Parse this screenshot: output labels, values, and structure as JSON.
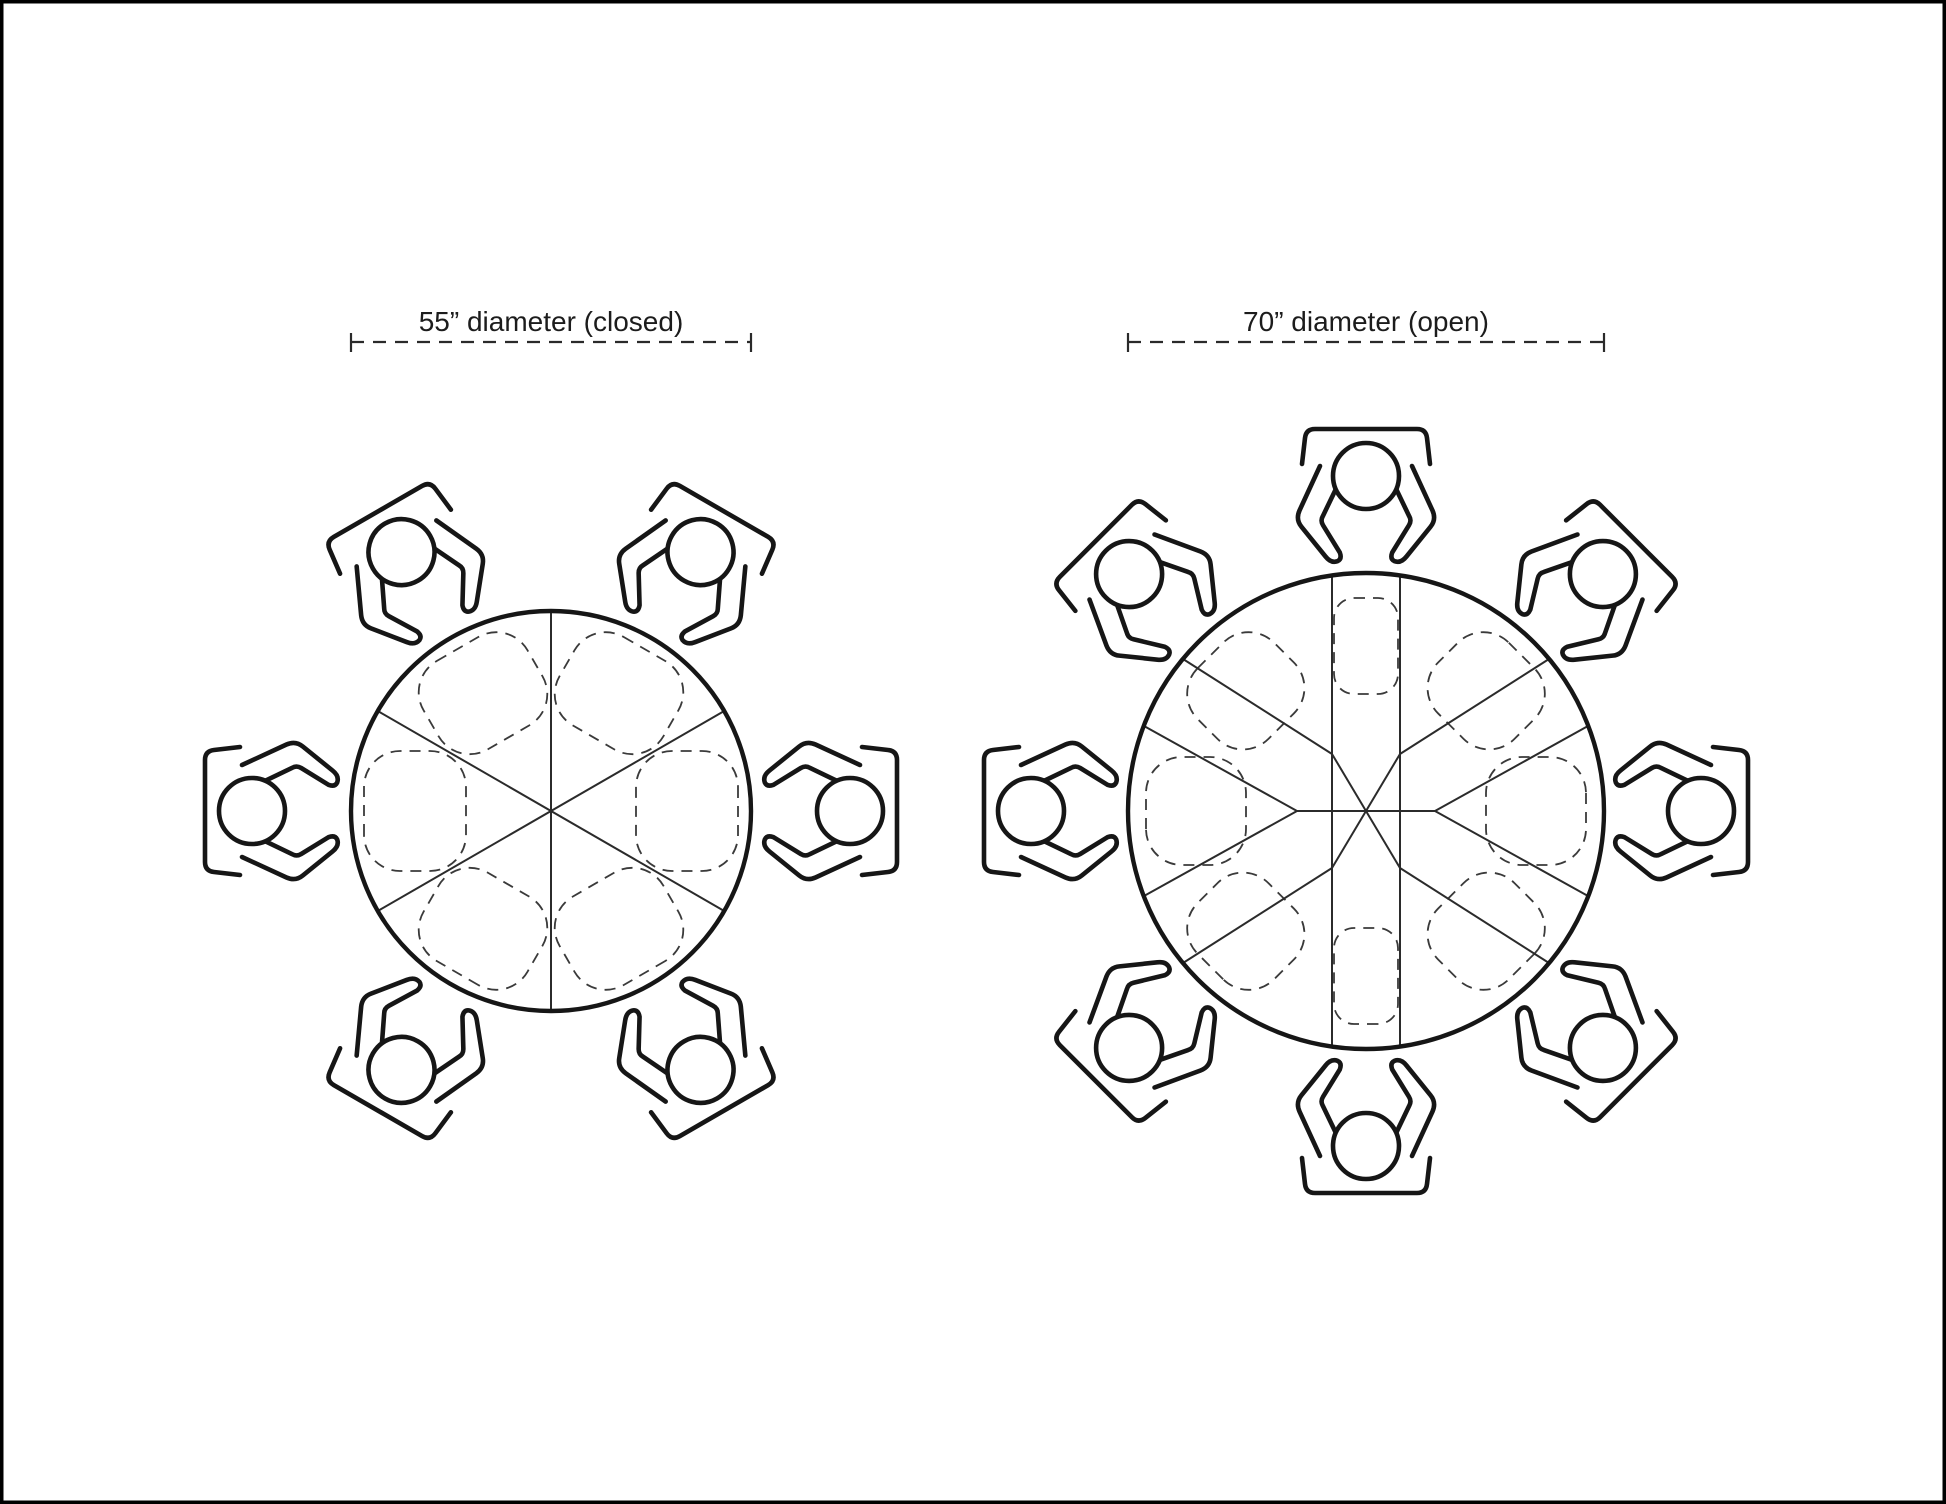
{
  "page": {
    "background_color": "#ffffff",
    "frame_color": "#000000",
    "line_color": "#1a1a1a",
    "dashed_color": "#3a3a3a"
  },
  "diagrams": {
    "closed": {
      "label": "55” diameter (closed)",
      "diameter_inches": 55,
      "state": "closed",
      "seats": 6
    },
    "open": {
      "label": "70” diameter (open)",
      "diameter_inches": 70,
      "state": "open",
      "seats": 8
    }
  },
  "icons": {
    "seated_person": "top-view person seated in chair",
    "place_setting": "dashed place-setting outline",
    "dimension_line": "dashed dimension line with end ticks"
  }
}
